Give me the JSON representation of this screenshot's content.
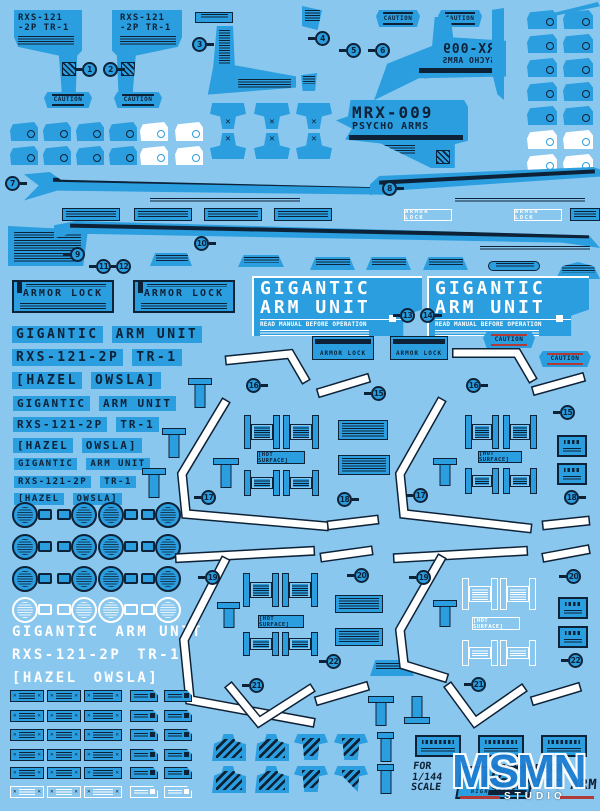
{
  "colors": {
    "background": "#8AC7EE",
    "decal_blue": "#2B9EDF",
    "ink": "#0D2137",
    "white": "#FFFFFF",
    "accent_red": "#B23A36",
    "watermark_blue": "#1E7FD2"
  },
  "texts": {
    "unit_code_l1": "RXS-121",
    "unit_code_l2": "-2P TR-1",
    "mrx_l1": "MRX-009",
    "mrx_l2": "PSYCHO ARMS",
    "caution": "CAUTION",
    "armor_lock": "ARMOR LOCK",
    "gig_l1": "GIGANTIC",
    "gig_l2": "ARM UNIT",
    "read_manual": "READ MANUAL BEFORE OPERATION",
    "w_unit_a": "GIGANTIC",
    "w_unit_b": "ARM UNIT",
    "w_code_a": "RXS-121-2P",
    "w_code_b": "TR-1",
    "w_pilot_a": "[HAZEL",
    "w_pilot_b": "OWSLA]",
    "hot_surface": "[HOT SURFACE]",
    "scale_l1": "FOR",
    "scale_l2": "1/144",
    "scale_l3": "SCALE",
    "hg": "HG",
    "high_grade": "HIGH GRADE",
    "brand_l1": "DELPI DECAL",
    "brand_l2": "GIGANTIC ARM",
    "watermark": "MSMN",
    "watermark_sub": "STUDIO"
  },
  "markers": [
    "1",
    "2",
    "3",
    "4",
    "5",
    "6",
    "7",
    "8",
    "9",
    "10",
    "11",
    "12",
    "13",
    "14",
    "15",
    "16",
    "17",
    "18",
    "19",
    "20",
    "21",
    "22"
  ]
}
